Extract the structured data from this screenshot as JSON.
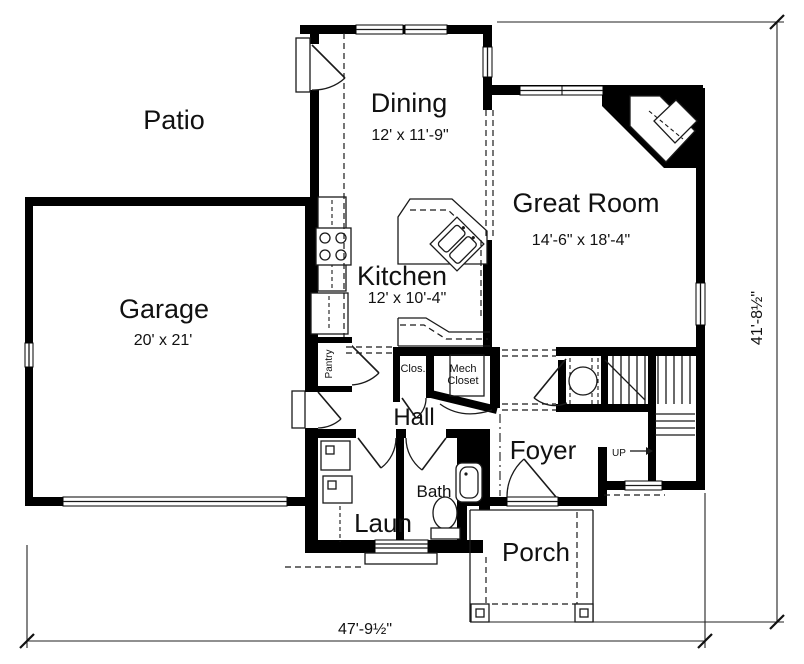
{
  "rooms": {
    "patio": {
      "label": "Patio"
    },
    "garage": {
      "label": "Garage",
      "dims": "20' x 21'"
    },
    "dining": {
      "label": "Dining",
      "dims": "12' x 11'-9\""
    },
    "great_room": {
      "label": "Great Room",
      "dims": "14'-6\" x 18'-4\""
    },
    "kitchen": {
      "label": "Kitchen",
      "dims": "12' x 10'-4\""
    },
    "hall": {
      "label": "Hall"
    },
    "foyer": {
      "label": "Foyer"
    },
    "bath": {
      "label": "Bath"
    },
    "laundry": {
      "label": "Laun"
    },
    "porch": {
      "label": "Porch"
    },
    "pantry": {
      "label": "Pantry"
    },
    "closet": {
      "label": "Clos."
    },
    "mech_closet": {
      "label_line1": "Mech",
      "label_line2": "Closet"
    },
    "stairs": {
      "direction_label": "UP"
    }
  },
  "dimensions": {
    "overall_width": "47'-9½\"",
    "overall_height": "41'-8½\""
  },
  "style": {
    "wall_color": "#000000",
    "line_color": "#1a1a1a",
    "background": "#ffffff",
    "text_color": "#111111"
  }
}
